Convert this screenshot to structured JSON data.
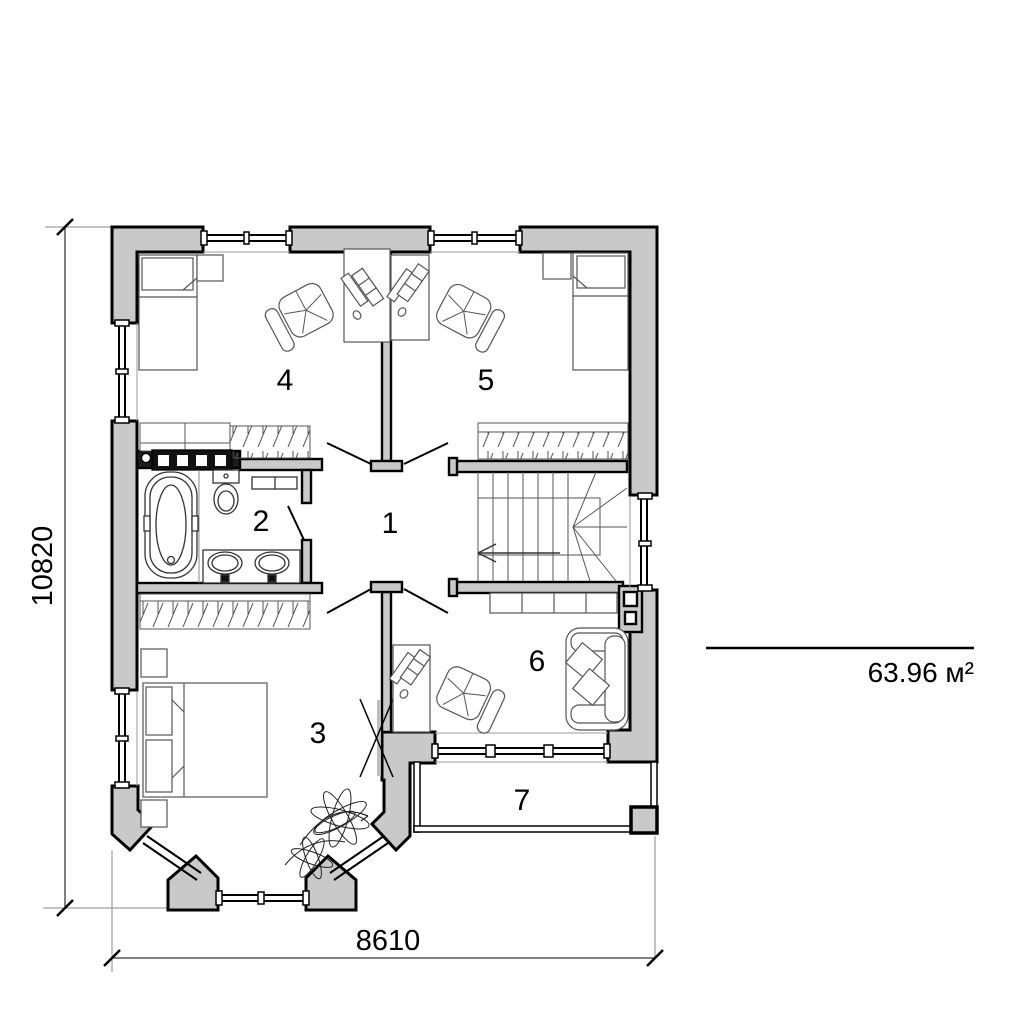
{
  "rooms": [
    {
      "label": "1"
    },
    {
      "label": "2"
    },
    {
      "label": "3"
    },
    {
      "label": "4"
    },
    {
      "label": "5"
    },
    {
      "label": "6"
    },
    {
      "label": "7"
    }
  ],
  "dimensions": {
    "vertical": "10820",
    "horizontal": "8610"
  },
  "area_label": "63.96 м²",
  "colors": {
    "wall_fill": "#c9c9c9",
    "outline": "#000000"
  }
}
